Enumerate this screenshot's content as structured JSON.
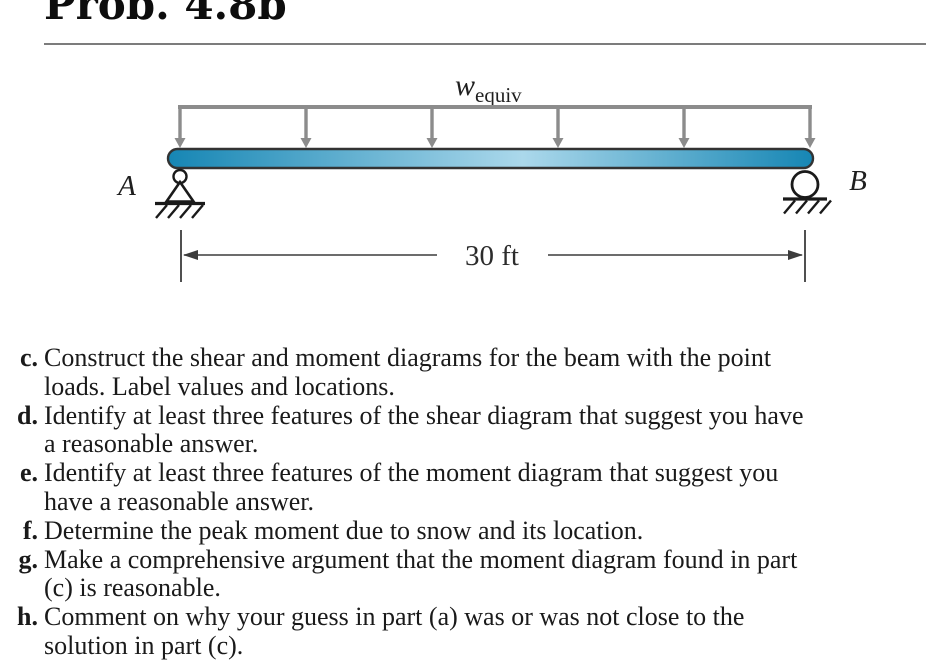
{
  "page": {
    "title": "Prob. 4.8b"
  },
  "diagram": {
    "load_label_main": "w",
    "load_label_sub": "equiv",
    "support_a_label": "A",
    "support_b_label": "B",
    "dimension_label": "30 ft",
    "span_ft": 30,
    "arrow_count": 6,
    "colors": {
      "load_gray": "#8c8c8c",
      "beam_end": "#1686b4",
      "beam_mid": "#abd8eb",
      "beam_outline": "#333333",
      "support_ink": "#1a1a1a",
      "dimension_ink": "#3c3c3c"
    }
  },
  "problem": {
    "items": [
      {
        "label": "c.",
        "text": "Construct the shear and moment diagrams for the beam with the point\nloads. Label values and locations."
      },
      {
        "label": "d.",
        "text": "Identify at least three features of the shear diagram that suggest you have\na reasonable answer."
      },
      {
        "label": "e.",
        "text": "Identify at least three features of the moment diagram that suggest you\nhave a reasonable answer."
      },
      {
        "label": "f.",
        "text": "Determine the peak moment due to snow and its location."
      },
      {
        "label": "g.",
        "text": "Make a comprehensive argument that the moment diagram found in part\n(c) is reasonable."
      },
      {
        "label": "h.",
        "text": "Comment on why your guess in part (a) was or was not close to the\nsolution in part (c)."
      }
    ]
  }
}
